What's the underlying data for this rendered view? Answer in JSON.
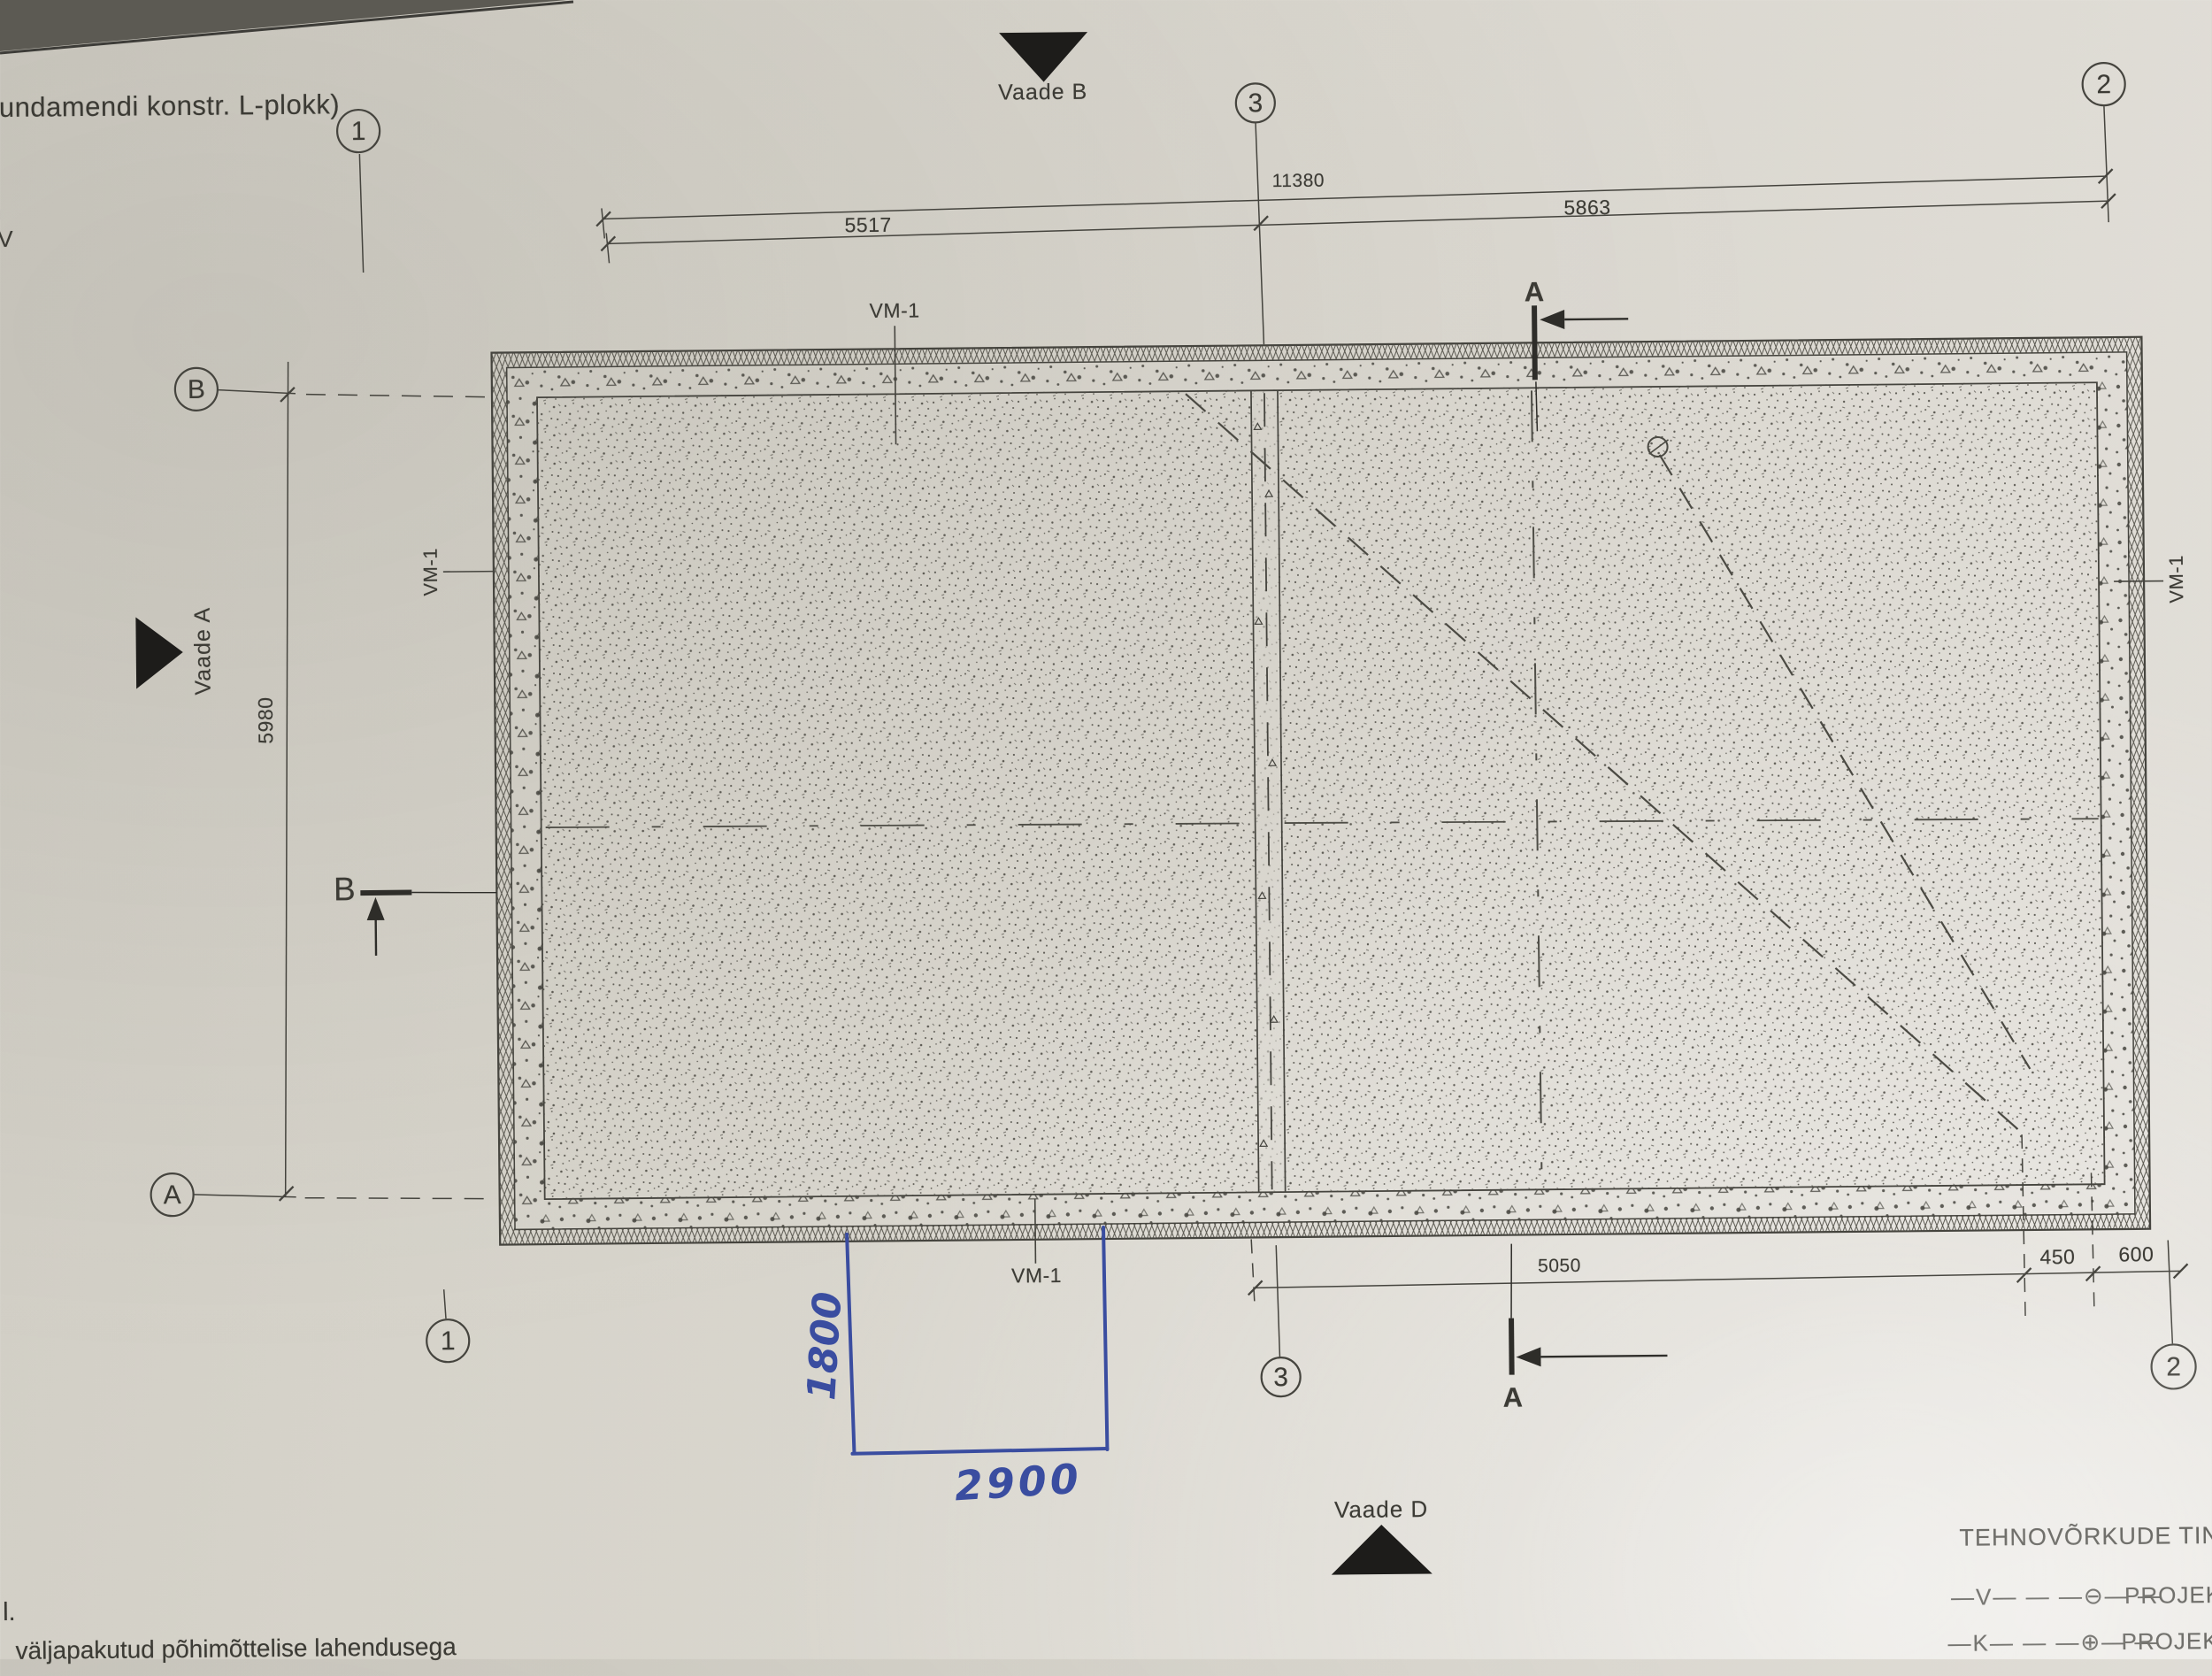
{
  "title": "Vundamendi konstr. L-plokk)",
  "edge_fragments": {
    "line1": "n",
    "line2": "V"
  },
  "views": {
    "a": "Vaade A",
    "b": "Vaade B",
    "d": "Vaade D"
  },
  "grid_axes": {
    "top": [
      "1",
      "3",
      "2"
    ],
    "bottom": [
      "1",
      "3",
      "2"
    ],
    "left": [
      "B",
      "A"
    ]
  },
  "section_markers": {
    "a": "A",
    "b": "B"
  },
  "dimensions": {
    "total_width": "11380",
    "span_left": "5517",
    "span_right": "5863",
    "height_left": "5980",
    "span_bottom": "5050",
    "offset_450": "450",
    "offset_600": "600"
  },
  "element_labels": {
    "vm1": "VM-1"
  },
  "handwritten": {
    "height": "1800",
    "width": "2900",
    "ink_color": "#3a4da0"
  },
  "legend": {
    "title": "TEHNOVÕRKUDE TINGMÄRGID",
    "rows": [
      {
        "symbols": "—V— — —⊖— —",
        "label": "PROJEKTET"
      },
      {
        "symbols": "—K— — —⊕— —",
        "label": "PROJEKTE"
      }
    ]
  },
  "footer": {
    "fragment": "l.",
    "text": "väljapakutud põhimõttelise lahendusega"
  },
  "drawing_colors": {
    "ink": "#3e3d37",
    "paper": "#d9d5cc",
    "blue_ink": "#3a4da0"
  }
}
